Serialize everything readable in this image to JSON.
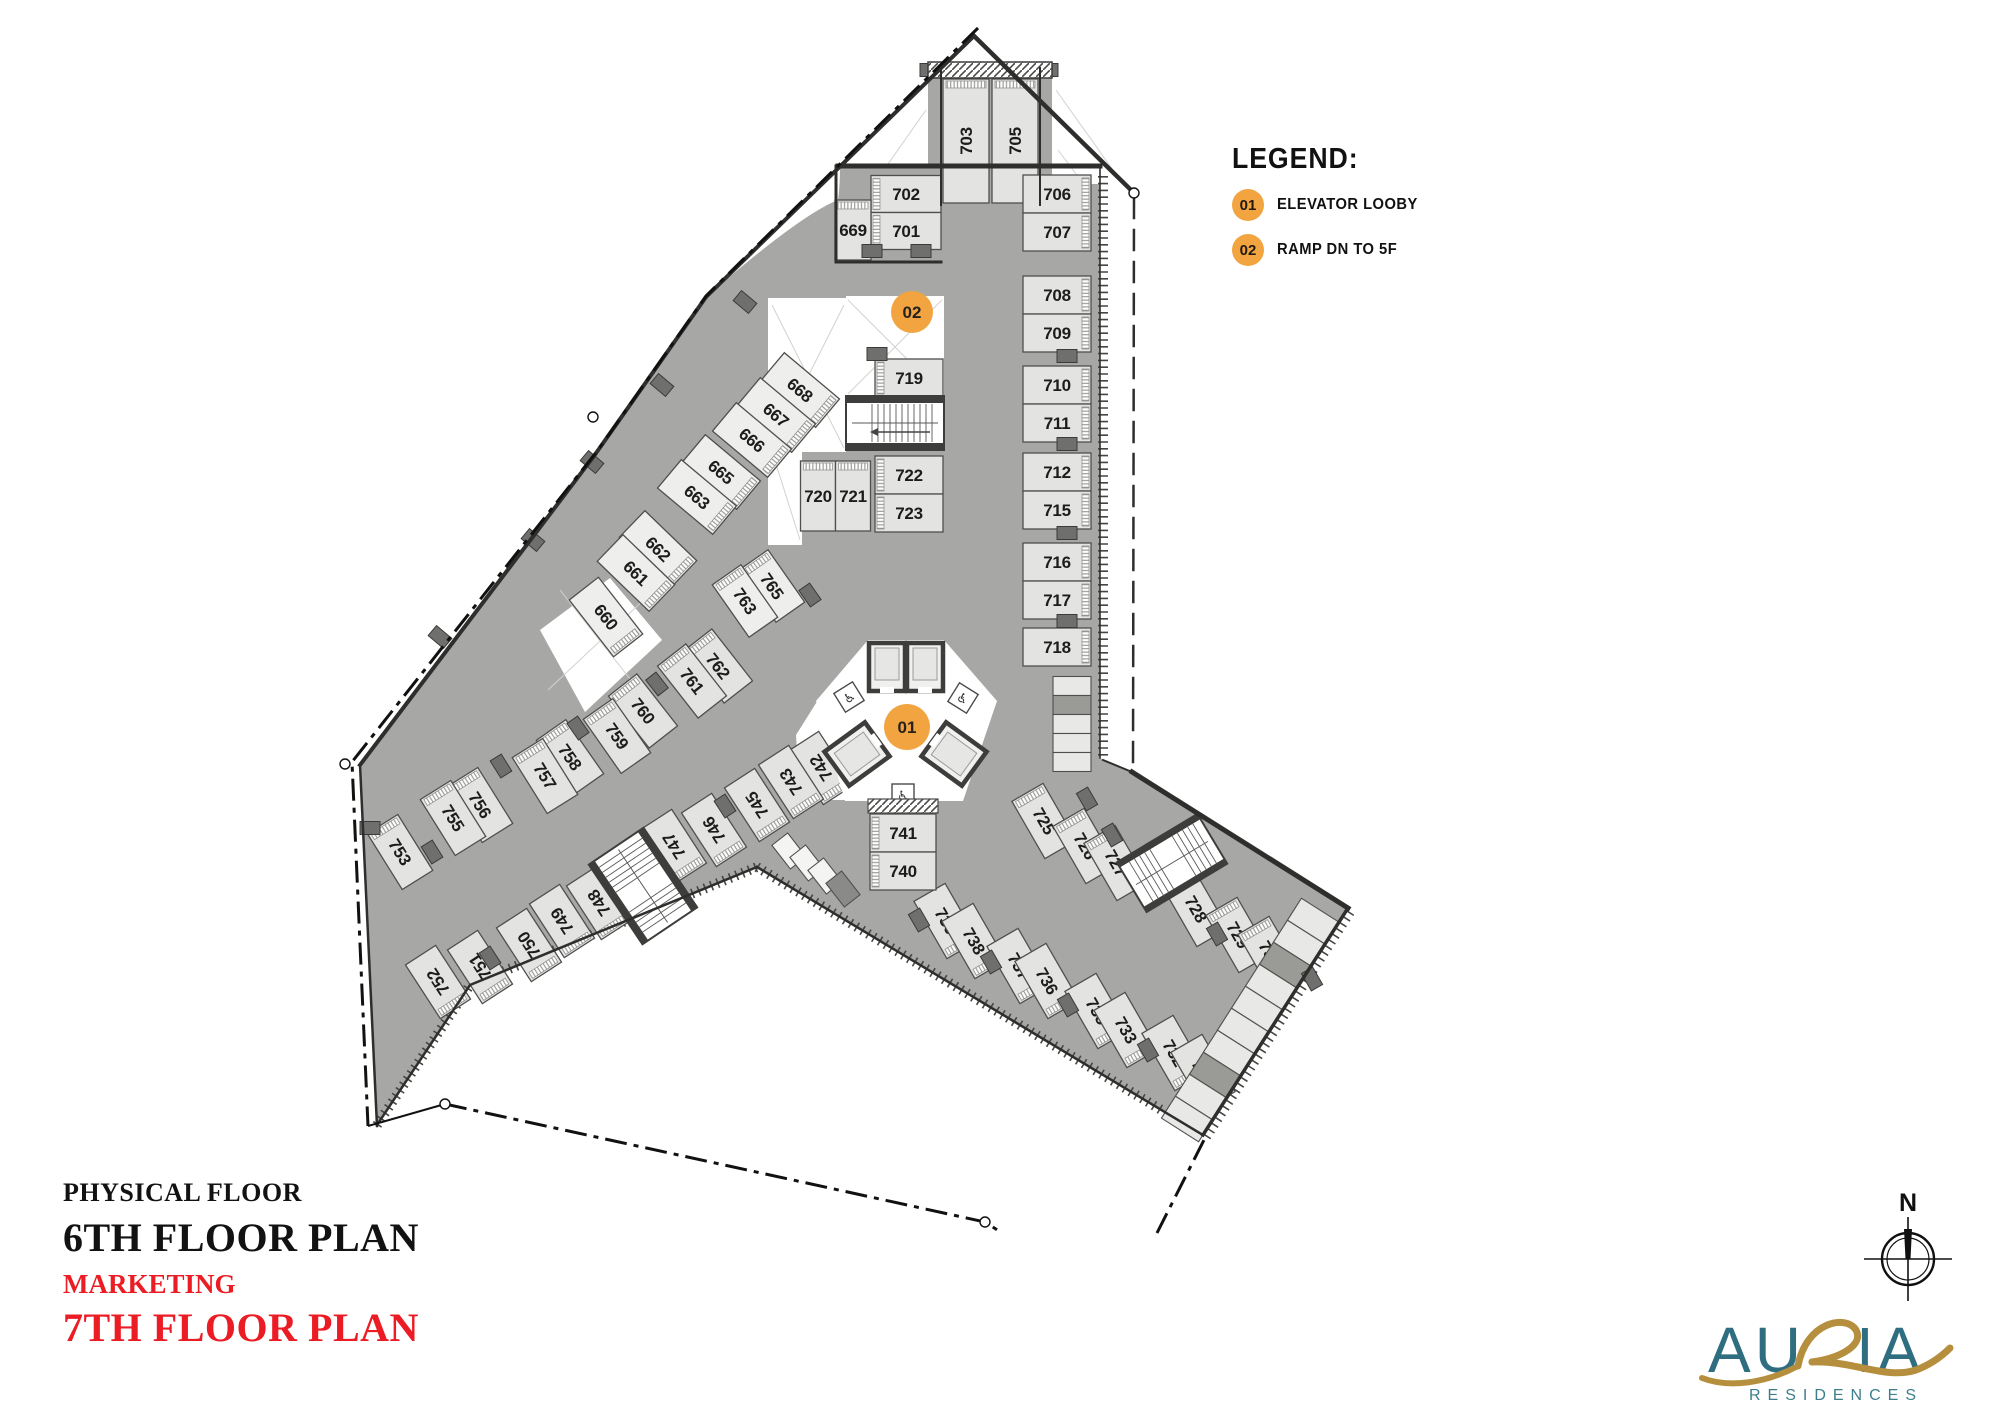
{
  "legend": {
    "title": "LEGEND:",
    "items": [
      {
        "badge": "01",
        "label": "ELEVATOR LOOBY"
      },
      {
        "badge": "02",
        "label": "RAMP DN TO 5F"
      }
    ]
  },
  "titles": {
    "line1": "PHYSICAL FLOOR",
    "line2": "6TH FLOOR PLAN",
    "line3": "MARKETING",
    "line4": "7TH FLOOR PLAN"
  },
  "branding": {
    "logo_main_left": "AU",
    "logo_main_right": "IA",
    "logo_sub": "RESIDENCES",
    "compass_label": "N"
  },
  "colors": {
    "accent_orange": "#F2A441",
    "title_red": "#EC1C24",
    "logo_teal": "#2F6E80",
    "logo_gold": "#B68F3E",
    "plate_gray": "#a7a8a5",
    "stall_fill": "#e3e3e1",
    "stall_light": "#eeeeec",
    "wall_dark": "#3d3d3b"
  },
  "markers": [
    {
      "label": "01",
      "x": 907,
      "y": 727,
      "r": 23
    },
    {
      "label": "02",
      "x": 912,
      "y": 312,
      "r": 21
    }
  ],
  "plan": {
    "stalls": [
      {
        "n": "703",
        "x": 966,
        "y": 141,
        "w": 46,
        "h": 124,
        "r": 0,
        "lr": -90,
        "hs": "top"
      },
      {
        "n": "705",
        "x": 1015,
        "y": 141,
        "w": 46,
        "h": 124,
        "r": 0,
        "lr": -90,
        "hs": "top"
      },
      {
        "n": "702",
        "x": 906,
        "y": 194,
        "w": 70,
        "h": 37,
        "r": 0,
        "lr": 0,
        "hs": "left"
      },
      {
        "n": "701",
        "x": 906,
        "y": 231,
        "w": 70,
        "h": 37,
        "r": 0,
        "lr": 0,
        "hs": "left"
      },
      {
        "n": "669",
        "x": 853,
        "y": 230,
        "w": 36,
        "h": 60,
        "r": 0,
        "lr": 0,
        "hs": "top"
      },
      {
        "n": "706",
        "x": 1057,
        "y": 194,
        "w": 68,
        "h": 38,
        "r": 0,
        "lr": 0,
        "hs": "right"
      },
      {
        "n": "707",
        "x": 1057,
        "y": 232,
        "w": 68,
        "h": 38,
        "r": 0,
        "lr": 0,
        "hs": "right"
      },
      {
        "n": "708",
        "x": 1057,
        "y": 295,
        "w": 68,
        "h": 38,
        "r": 0,
        "lr": 0,
        "hs": "right"
      },
      {
        "n": "709",
        "x": 1057,
        "y": 333,
        "w": 68,
        "h": 38,
        "r": 0,
        "lr": 0,
        "hs": "right"
      },
      {
        "n": "710",
        "x": 1057,
        "y": 385,
        "w": 68,
        "h": 38,
        "r": 0,
        "lr": 0,
        "hs": "right"
      },
      {
        "n": "711",
        "x": 1057,
        "y": 423,
        "w": 68,
        "h": 38,
        "r": 0,
        "lr": 0,
        "hs": "right"
      },
      {
        "n": "712",
        "x": 1057,
        "y": 472,
        "w": 68,
        "h": 38,
        "r": 0,
        "lr": 0,
        "hs": "right"
      },
      {
        "n": "715",
        "x": 1057,
        "y": 510,
        "w": 68,
        "h": 38,
        "r": 0,
        "lr": 0,
        "hs": "right"
      },
      {
        "n": "716",
        "x": 1057,
        "y": 562,
        "w": 68,
        "h": 38,
        "r": 0,
        "lr": 0,
        "hs": "right"
      },
      {
        "n": "717",
        "x": 1057,
        "y": 600,
        "w": 68,
        "h": 38,
        "r": 0,
        "lr": 0,
        "hs": "right"
      },
      {
        "n": "718",
        "x": 1057,
        "y": 647,
        "w": 68,
        "h": 38,
        "r": 0,
        "lr": 0,
        "hs": "right"
      },
      {
        "n": "719",
        "x": 909,
        "y": 378,
        "w": 68,
        "h": 38,
        "r": 0,
        "lr": 0,
        "hs": "left"
      },
      {
        "n": "722",
        "x": 909,
        "y": 475,
        "w": 68,
        "h": 38,
        "r": 0,
        "lr": 0,
        "hs": "left"
      },
      {
        "n": "723",
        "x": 909,
        "y": 513,
        "w": 68,
        "h": 38,
        "r": 0,
        "lr": 0,
        "hs": "left"
      },
      {
        "n": "720",
        "x": 818,
        "y": 496,
        "w": 35,
        "h": 70,
        "r": 0,
        "lr": 0,
        "hs": "top"
      },
      {
        "n": "721",
        "x": 853,
        "y": 496,
        "w": 35,
        "h": 70,
        "r": 0,
        "lr": 0,
        "hs": "top"
      },
      {
        "n": "668",
        "x": 800,
        "y": 390,
        "w": 72,
        "h": 37,
        "r": 40,
        "lr": 40,
        "hs": "right",
        "f": 1
      },
      {
        "n": "667",
        "x": 776,
        "y": 415,
        "w": 72,
        "h": 37,
        "r": 40,
        "lr": 40,
        "hs": "right",
        "f": 1
      },
      {
        "n": "666",
        "x": 752,
        "y": 440,
        "w": 72,
        "h": 37,
        "r": 40,
        "lr": 40,
        "hs": "right",
        "f": 1
      },
      {
        "n": "665",
        "x": 721,
        "y": 472,
        "w": 72,
        "h": 37,
        "r": 40,
        "lr": 40,
        "hs": "right",
        "f": 1
      },
      {
        "n": "663",
        "x": 697,
        "y": 497,
        "w": 72,
        "h": 37,
        "r": 40,
        "lr": 40,
        "hs": "right",
        "f": 1
      },
      {
        "n": "662",
        "x": 658,
        "y": 549,
        "w": 72,
        "h": 37,
        "r": 44,
        "lr": 44,
        "hs": "right",
        "f": 1
      },
      {
        "n": "661",
        "x": 636,
        "y": 573,
        "w": 72,
        "h": 37,
        "r": 44,
        "lr": 44,
        "hs": "right",
        "f": 1
      },
      {
        "n": "660",
        "x": 606,
        "y": 617,
        "w": 72,
        "h": 37,
        "r": 52,
        "lr": 52,
        "hs": "right",
        "f": 1
      },
      {
        "n": "765",
        "x": 772,
        "y": 586,
        "w": 64,
        "h": 35,
        "r": 55,
        "lr": 55,
        "hs": "left",
        "f": 1
      },
      {
        "n": "763",
        "x": 745,
        "y": 601,
        "w": 64,
        "h": 35,
        "r": 55,
        "lr": 55,
        "hs": "left",
        "f": 1
      },
      {
        "n": "762",
        "x": 718,
        "y": 666,
        "w": 66,
        "h": 36,
        "r": 52,
        "lr": 52,
        "hs": "left"
      },
      {
        "n": "761",
        "x": 692,
        "y": 681,
        "w": 66,
        "h": 36,
        "r": 52,
        "lr": 52,
        "hs": "left"
      },
      {
        "n": "760",
        "x": 643,
        "y": 711,
        "w": 66,
        "h": 36,
        "r": 52,
        "lr": 52,
        "hs": "left"
      },
      {
        "n": "759",
        "x": 617,
        "y": 736,
        "w": 66,
        "h": 36,
        "r": 55,
        "lr": 55,
        "hs": "left"
      },
      {
        "n": "758",
        "x": 570,
        "y": 757,
        "w": 66,
        "h": 36,
        "r": 55,
        "lr": 55,
        "hs": "left"
      },
      {
        "n": "757",
        "x": 545,
        "y": 776,
        "w": 66,
        "h": 36,
        "r": 58,
        "lr": 58,
        "hs": "left"
      },
      {
        "n": "756",
        "x": 480,
        "y": 805,
        "w": 66,
        "h": 36,
        "r": 58,
        "lr": 58,
        "hs": "left"
      },
      {
        "n": "755",
        "x": 453,
        "y": 818,
        "w": 66,
        "h": 36,
        "r": 58,
        "lr": 58,
        "hs": "left"
      },
      {
        "n": "753",
        "x": 400,
        "y": 852,
        "w": 66,
        "h": 36,
        "r": 58,
        "lr": 58,
        "hs": "left"
      },
      {
        "n": "742",
        "x": 821,
        "y": 768,
        "w": 64,
        "h": 36,
        "r": 57,
        "lr": 237,
        "hs": "right"
      },
      {
        "n": "743",
        "x": 791,
        "y": 782,
        "w": 64,
        "h": 36,
        "r": 57,
        "lr": 237,
        "hs": "right"
      },
      {
        "n": "745",
        "x": 757,
        "y": 805,
        "w": 64,
        "h": 36,
        "r": 57,
        "lr": 237,
        "hs": "right"
      },
      {
        "n": "746",
        "x": 714,
        "y": 830,
        "w": 64,
        "h": 36,
        "r": 57,
        "lr": 237,
        "hs": "right"
      },
      {
        "n": "747",
        "x": 674,
        "y": 846,
        "w": 64,
        "h": 36,
        "r": 57,
        "lr": 237,
        "hs": "right"
      },
      {
        "n": "748",
        "x": 599,
        "y": 903,
        "w": 64,
        "h": 36,
        "r": 57,
        "lr": 237,
        "hs": "right"
      },
      {
        "n": "749",
        "x": 562,
        "y": 921,
        "w": 64,
        "h": 36,
        "r": 57,
        "lr": 237,
        "hs": "right"
      },
      {
        "n": "750",
        "x": 529,
        "y": 945,
        "w": 64,
        "h": 36,
        "r": 57,
        "lr": 237,
        "hs": "right"
      },
      {
        "n": "751",
        "x": 480,
        "y": 967,
        "w": 64,
        "h": 36,
        "r": 57,
        "lr": 237,
        "hs": "right"
      },
      {
        "n": "752",
        "x": 438,
        "y": 982,
        "w": 64,
        "h": 36,
        "r": 57,
        "lr": 237,
        "hs": "right"
      },
      {
        "n": "739",
        "x": 946,
        "y": 921,
        "w": 66,
        "h": 36,
        "r": 60,
        "lr": 60,
        "hs": "right"
      },
      {
        "n": "738",
        "x": 974,
        "y": 941,
        "w": 66,
        "h": 36,
        "r": 60,
        "lr": 60,
        "hs": "right"
      },
      {
        "n": "737",
        "x": 1019,
        "y": 966,
        "w": 66,
        "h": 36,
        "r": 60,
        "lr": 60,
        "hs": "right"
      },
      {
        "n": "736",
        "x": 1047,
        "y": 981,
        "w": 66,
        "h": 36,
        "r": 60,
        "lr": 60,
        "hs": "right"
      },
      {
        "n": "735",
        "x": 1097,
        "y": 1011,
        "w": 66,
        "h": 36,
        "r": 60,
        "lr": 60,
        "hs": "right"
      },
      {
        "n": "733",
        "x": 1126,
        "y": 1030,
        "w": 66,
        "h": 36,
        "r": 60,
        "lr": 60,
        "hs": "right"
      },
      {
        "n": "732",
        "x": 1174,
        "y": 1053,
        "w": 66,
        "h": 36,
        "r": 60,
        "lr": 60,
        "hs": "right"
      },
      {
        "n": "731",
        "x": 1203,
        "y": 1072,
        "w": 66,
        "h": 36,
        "r": 60,
        "lr": 60,
        "hs": "right"
      },
      {
        "n": "725",
        "x": 1044,
        "y": 821,
        "w": 66,
        "h": 36,
        "r": 60,
        "lr": 60,
        "hs": "left"
      },
      {
        "n": "726",
        "x": 1085,
        "y": 846,
        "w": 66,
        "h": 36,
        "r": 60,
        "lr": 60,
        "hs": "left"
      },
      {
        "n": "727",
        "x": 1116,
        "y": 863,
        "w": 66,
        "h": 36,
        "r": 60,
        "lr": 60,
        "hs": "left"
      },
      {
        "n": "728",
        "x": 1196,
        "y": 909,
        "w": 66,
        "h": 36,
        "r": 60,
        "lr": 60,
        "hs": "left"
      },
      {
        "n": "729",
        "x": 1238,
        "y": 935,
        "w": 66,
        "h": 36,
        "r": 60,
        "lr": 60,
        "hs": "left"
      },
      {
        "n": "730",
        "x": 1270,
        "y": 954,
        "w": 66,
        "h": 36,
        "r": 60,
        "lr": 60,
        "hs": "left"
      },
      {
        "n": "741",
        "x": 903,
        "y": 833,
        "w": 66,
        "h": 38,
        "r": 0,
        "lr": 0,
        "hs": "left"
      },
      {
        "n": "740",
        "x": 903,
        "y": 871,
        "w": 66,
        "h": 38,
        "r": 0,
        "lr": 0,
        "hs": "left"
      }
    ],
    "columns": [
      [
        872,
        251,
        0
      ],
      [
        921,
        251,
        0
      ],
      [
        930,
        70,
        0
      ],
      [
        1048,
        70,
        0
      ],
      [
        877,
        354,
        0
      ],
      [
        1067,
        356,
        0
      ],
      [
        1067,
        444,
        0
      ],
      [
        1067,
        533,
        0
      ],
      [
        1067,
        621,
        0
      ],
      [
        745,
        302,
        40
      ],
      [
        662,
        385,
        40
      ],
      [
        592,
        462,
        40
      ],
      [
        533,
        540,
        40
      ],
      [
        440,
        637,
        40
      ],
      [
        370,
        828,
        0
      ],
      [
        810,
        595,
        55
      ],
      [
        657,
        684,
        52
      ],
      [
        578,
        728,
        55
      ],
      [
        501,
        766,
        58
      ],
      [
        432,
        852,
        58
      ],
      [
        725,
        806,
        57
      ],
      [
        490,
        958,
        57
      ],
      [
        919,
        920,
        60
      ],
      [
        991,
        962,
        60
      ],
      [
        1068,
        1005,
        60
      ],
      [
        1148,
        1050,
        60
      ],
      [
        1087,
        799,
        60
      ],
      [
        1112,
        835,
        60
      ],
      [
        1217,
        934,
        60
      ],
      [
        1312,
        979,
        60
      ]
    ],
    "lockers": [
      {
        "x": 1072,
        "y": 686,
        "w": 38,
        "h": 19,
        "r": 0,
        "d": 0
      },
      {
        "x": 1072,
        "y": 705,
        "w": 38,
        "h": 19,
        "r": 0,
        "d": 1
      },
      {
        "x": 1072,
        "y": 724,
        "w": 38,
        "h": 19,
        "r": 0,
        "d": 0
      },
      {
        "x": 1072,
        "y": 743,
        "w": 38,
        "h": 19,
        "r": 0,
        "d": 0
      },
      {
        "x": 1072,
        "y": 762,
        "w": 38,
        "h": 19,
        "r": 0,
        "d": 0
      },
      {
        "x": 1313,
        "y": 921,
        "w": 44,
        "h": 26,
        "r": 32.5,
        "d": 0
      },
      {
        "x": 1299,
        "y": 943,
        "w": 44,
        "h": 26,
        "r": 32.5,
        "d": 0
      },
      {
        "x": 1285,
        "y": 965,
        "w": 44,
        "h": 26,
        "r": 32.5,
        "d": 1
      },
      {
        "x": 1271,
        "y": 987,
        "w": 44,
        "h": 26,
        "r": 32.5,
        "d": 0
      },
      {
        "x": 1257,
        "y": 1009,
        "w": 44,
        "h": 26,
        "r": 32.5,
        "d": 0
      },
      {
        "x": 1243,
        "y": 1031,
        "w": 44,
        "h": 26,
        "r": 32.5,
        "d": 0
      },
      {
        "x": 1229,
        "y": 1053,
        "w": 44,
        "h": 26,
        "r": 32.5,
        "d": 0
      },
      {
        "x": 1215,
        "y": 1075,
        "w": 44,
        "h": 26,
        "r": 32.5,
        "d": 1
      },
      {
        "x": 1201,
        "y": 1097,
        "w": 44,
        "h": 26,
        "r": 32.5,
        "d": 0
      },
      {
        "x": 1187,
        "y": 1119,
        "w": 44,
        "h": 26,
        "r": 32.5,
        "d": 0
      }
    ],
    "boxes": [
      {
        "x": 789,
        "y": 851,
        "d": 0
      },
      {
        "x": 807,
        "y": 863,
        "d": 0
      },
      {
        "x": 825,
        "y": 876,
        "d": 0
      },
      {
        "x": 843,
        "y": 889,
        "d": 1
      }
    ]
  }
}
